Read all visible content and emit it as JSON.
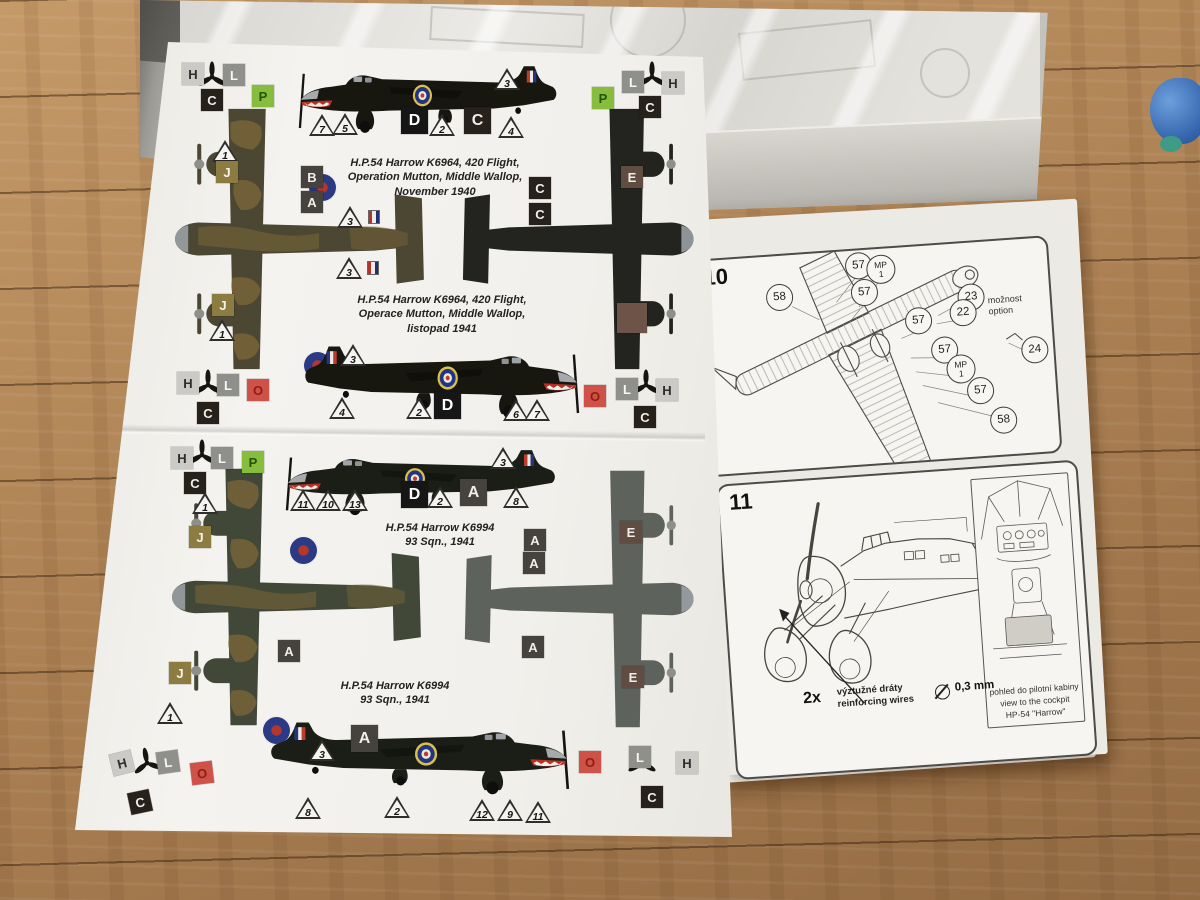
{
  "scene": {
    "description": "photo of a model-kit camouflage painting guide sheet and instruction booklet lying on a wooden floor beside the kit box with a plastic bag of sprues",
    "floor_color": "#ae8355",
    "paper_color": "#f3f2ee",
    "box_color": "#c9c8c3",
    "blue_object_color": "#3465ad"
  },
  "palette": {
    "H": "#cbcac6",
    "L": "#8f8f8b",
    "C": "#26211b",
    "P": "#86bd3c",
    "J": "#8d7c42",
    "O": "#d05148",
    "A": "#46423d",
    "B": "#46423d",
    "D": "#161616",
    "E": "#604c40",
    "brown_swatch": "#6d5348",
    "camouflage_green": "#4b4733",
    "night_black": "#232320",
    "dark_green": "#414838",
    "underside_grey": "#5e625c"
  },
  "letters": {
    "H": "H",
    "L": "L",
    "C": "C",
    "P": "P",
    "J": "J",
    "O": "O",
    "A": "A",
    "B": "B",
    "D": "D",
    "E": "E"
  },
  "tri": {
    "1": "1",
    "2": "2",
    "3": "3",
    "4": "4",
    "5": "5",
    "6": "6",
    "7": "7",
    "8": "8",
    "9": "9",
    "10": "10",
    "11": "11",
    "12": "12",
    "13": "13"
  },
  "captions": {
    "s1en": {
      "l1": "H.P.54 Harrow K6964, 420 Flight,",
      "l2": "Operation Mutton, Middle Wallop,",
      "l3": "November 1940"
    },
    "s1cz": {
      "l1": "H.P.54 Harrow K6964, 420 Flight,",
      "l2": "Operace Mutton, Middle Wallop,",
      "l3": "listopad 1941"
    },
    "s2a": {
      "l1": "H.P.54 Harrow K6994",
      "l2": "93 Sqn., 1941"
    },
    "s2b": {
      "l1": "H.P.54 Harrow K6994",
      "l2": "93 Sqn., 1941"
    }
  },
  "parts": {
    "p57": "57",
    "p58": "58",
    "p22": "22",
    "p23": "23",
    "p24": "24",
    "mp": "MP",
    "one": "1"
  },
  "steps": {
    "n10": "10",
    "n11": "11",
    "option": {
      "l1": "možnost",
      "l2": "option"
    },
    "qty": "2x",
    "wire": {
      "l1": "výztužné dráty",
      "l2": "reinforcing wires"
    },
    "dia": "0,3 mm",
    "cockpit": {
      "l1": "pohled do pilotní kabiny",
      "l2": "view to the cockpit",
      "l3": "HP-54 \"Harrow\""
    }
  }
}
